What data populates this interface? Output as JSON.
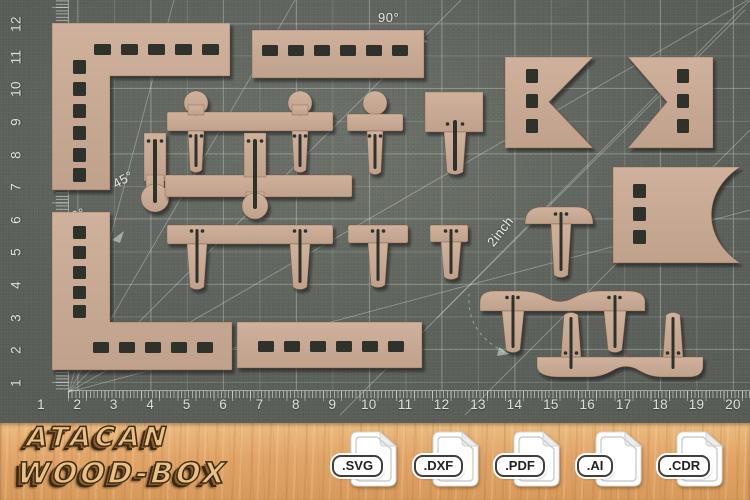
{
  "mat": {
    "h_ruler_numbers": [
      "1",
      "2",
      "3",
      "4",
      "5",
      "6",
      "7",
      "8",
      "9",
      "10",
      "11",
      "12",
      "13",
      "14",
      "15",
      "16",
      "17",
      "18",
      "19",
      "20"
    ],
    "v_ruler_numbers": [
      "1",
      "2",
      "3",
      "4",
      "5",
      "6",
      "7",
      "8",
      "9",
      "10",
      "11",
      "12"
    ],
    "angle_labels": [
      {
        "text": "90°",
        "x": 378,
        "y": 10,
        "rot": 0
      },
      {
        "text": "45°",
        "x": 110,
        "y": 178,
        "rot": -29
      },
      {
        "text": "30°",
        "x": 62,
        "y": 212,
        "rot": -20
      },
      {
        "text": "2inch",
        "x": 484,
        "y": 240,
        "rot": -52
      }
    ],
    "colors": {
      "base": "#575c57",
      "label": "#e8ece8"
    }
  },
  "pieces": {
    "wood": "#cfb19c",
    "wood_dark": "#c0a18b",
    "slot": "#2e302a"
  },
  "footer": {
    "brand_line1": "ATACAN",
    "brand_line2": "WOOD-BOX",
    "formats": [
      ".SVG",
      ".DXF",
      ".PDF",
      ".AI",
      ".CDR"
    ],
    "colors": {
      "wood_bg": "#e2a569",
      "letter_face": "#eac084",
      "letter_outline": "#3e2c12"
    }
  }
}
